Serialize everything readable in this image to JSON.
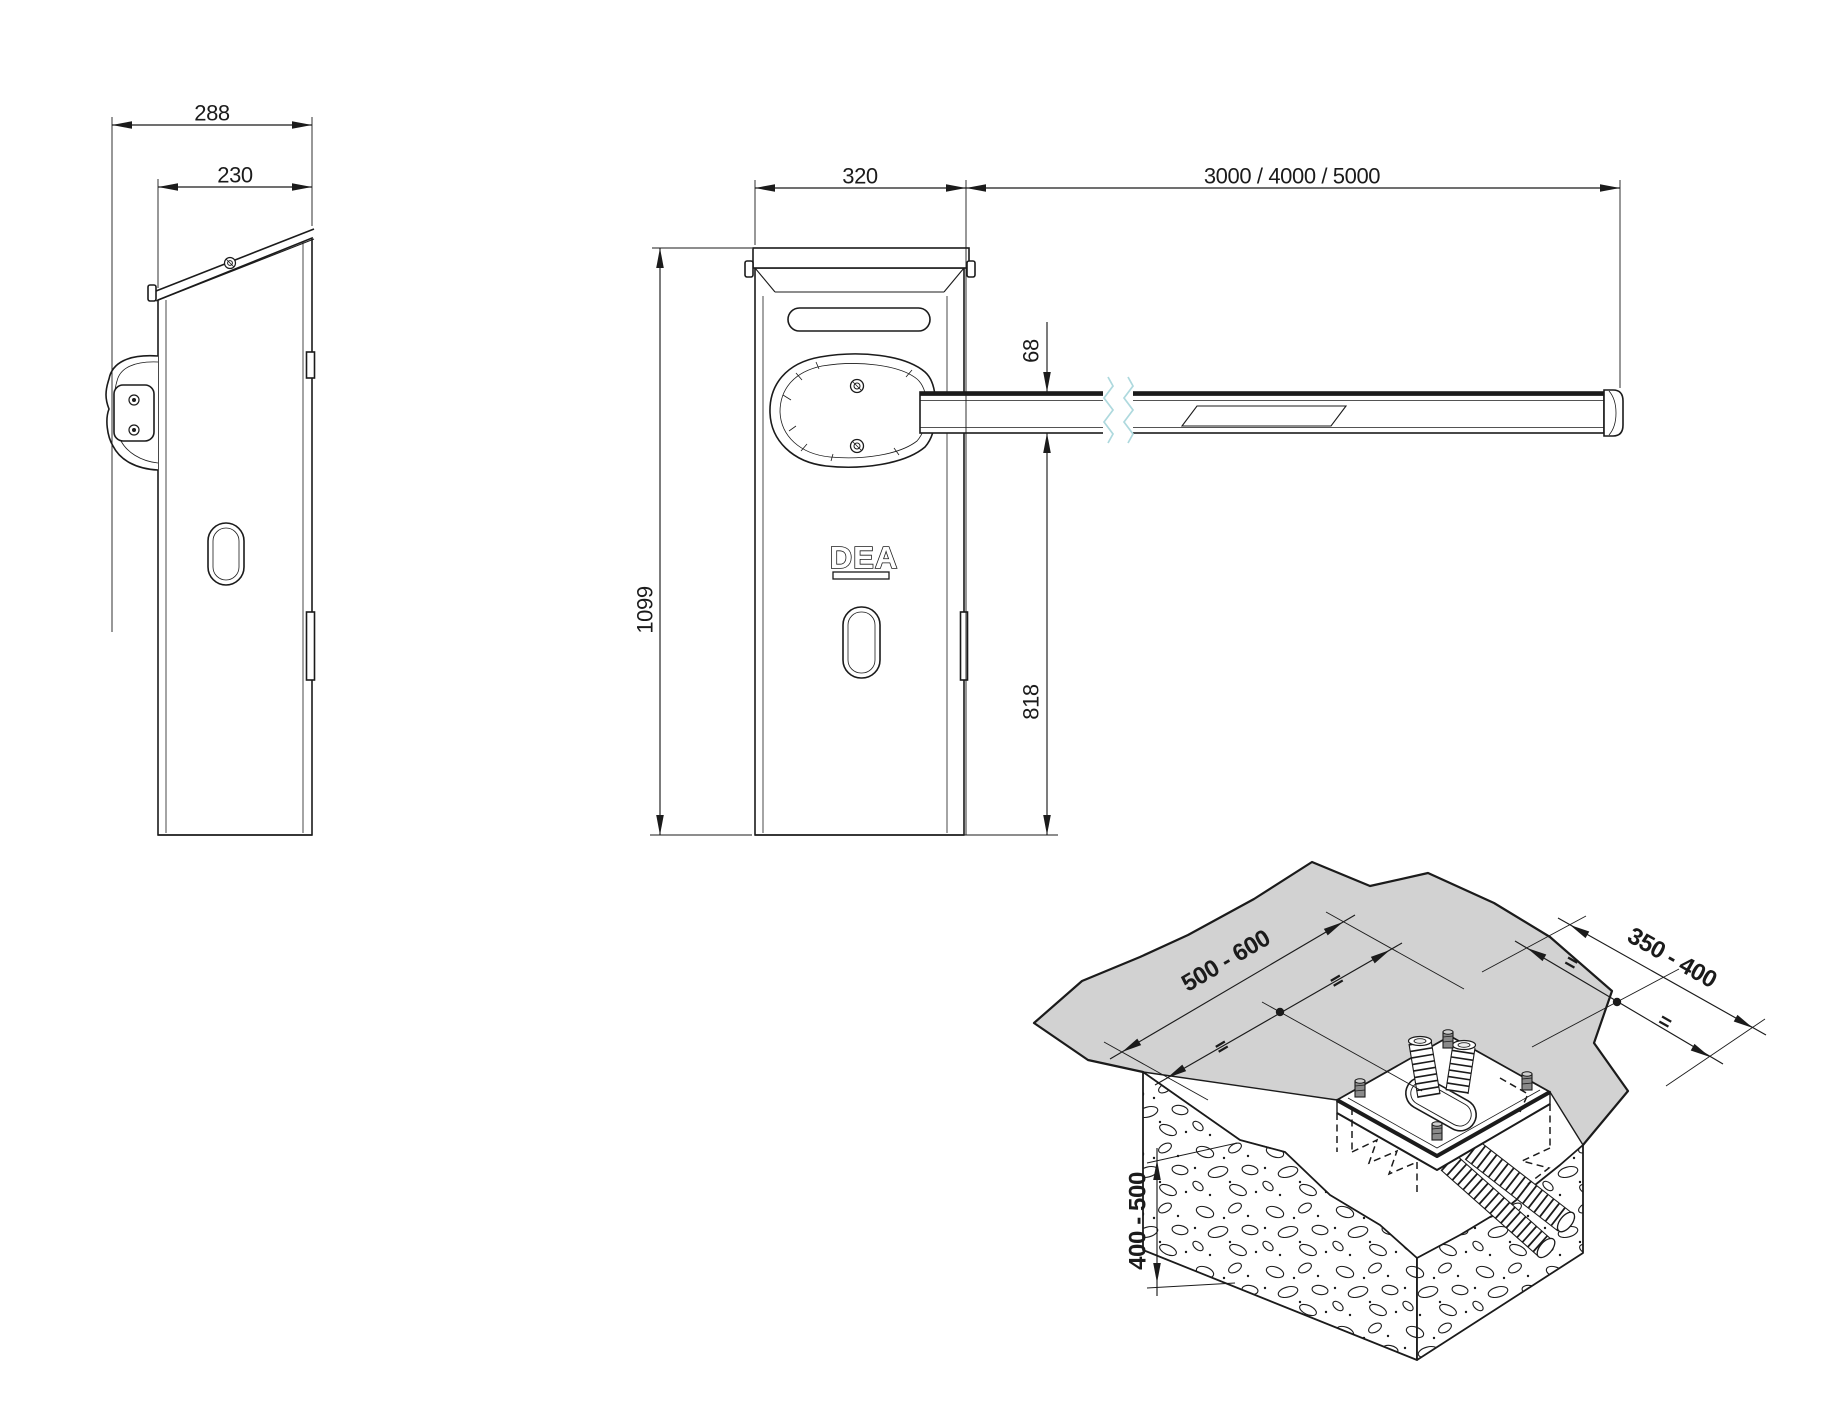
{
  "drawing": {
    "type": "technical-dimension-drawing",
    "product": "barrier gate with boom arm and foundation plate",
    "views": {
      "side": {
        "dims": {
          "overall_depth": "288",
          "body_depth": "230"
        }
      },
      "front": {
        "logo": "DEA",
        "dims": {
          "width": "320",
          "arm_lengths": "3000 / 4000 / 5000",
          "total_height": "1099",
          "arm_profile_height": "68",
          "arm_ground_clearance": "818"
        }
      },
      "foundation": {
        "equals_mark": "=",
        "dims": {
          "plate_axis_long": "500 - 600",
          "plate_axis_short": "350 - 400",
          "excavation_depth": "400 - 500"
        }
      }
    },
    "colors": {
      "line": "#1b1b1b",
      "ground_fill": "#d2d2d2",
      "break_line": "#aed9de"
    }
  }
}
